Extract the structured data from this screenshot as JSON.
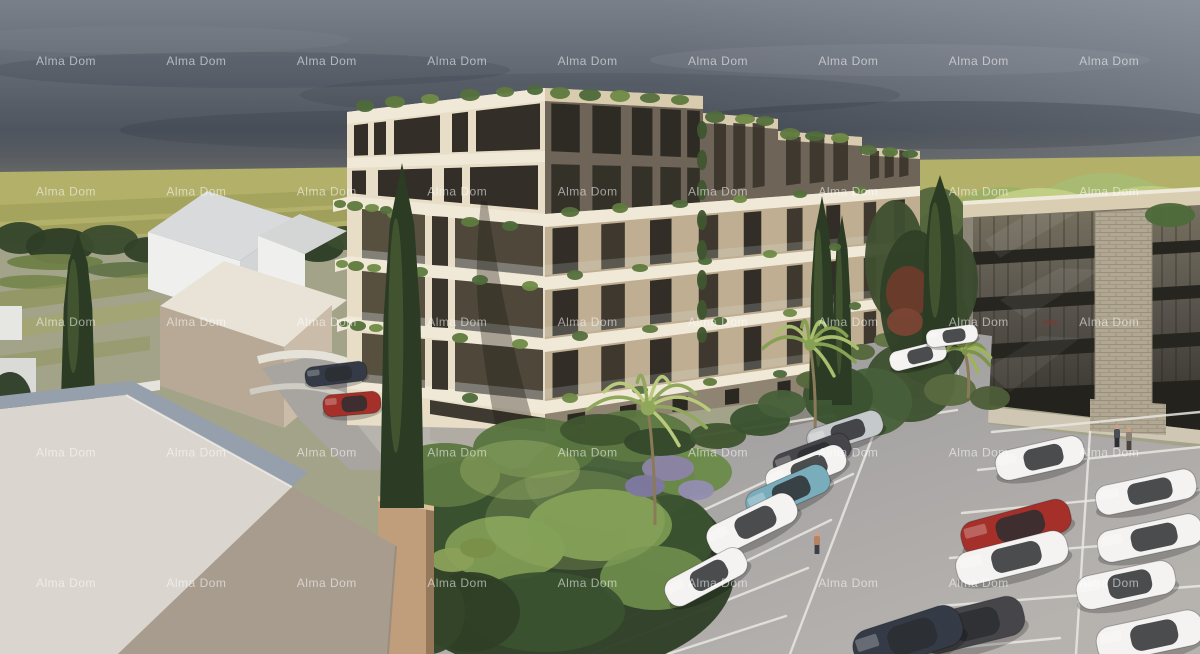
{
  "meta": {
    "type": "architectural-rendering",
    "title": "Alma Dom residential complex 3D visualization",
    "width": 1200,
    "height": 654
  },
  "watermark": {
    "text": "Alma Dom",
    "color": "rgba(255,255,255,0.55)",
    "font_size": 12,
    "grid": {
      "cols": 9,
      "rows": 5,
      "x_start": 66,
      "x_step": 130.4,
      "y_start": 65,
      "y_step": 130.5
    }
  },
  "palette": {
    "sky_top": "#79808a",
    "sky_mid": "#5d636d",
    "sky_low": "#474d57",
    "horizon": "#8f8d80",
    "field": "#b2b069",
    "field_dark": "#9b9c57",
    "ground": "#a2a389",
    "facade_light": "#e8dec8",
    "band_white": "#f1e9d7",
    "facade_tan": "#bfae92",
    "penthouse_dark": "#6e6457",
    "window_dark": "#332f28",
    "recess": "#4e473a",
    "recess2": "#57503f",
    "office_fascia": "#d9cdb2",
    "office_spandrel": "#26251f",
    "stone": "#b1a792",
    "asphalt": "#9c999c",
    "asphalt_light": "#b6b3af",
    "line": "#eae8e3",
    "concrete": "#b7b4ae",
    "roof_light": "#dad5ce",
    "roof_dark": "#a89c8e",
    "roof_blue": "#96a0ac",
    "massing_white": "#eff0ee",
    "massing_roof": "#d8dadb",
    "massing_tan": "#cabca8",
    "tanbox": "#c09e7c"
  },
  "scene": {
    "sky": "overcast evening sky",
    "background": "yellow-green field with dark tree line",
    "main_building": "6-storey apartment building, white balcony bands, rooftop greenery",
    "office_building": "4-storey dark glass building with stone pillar",
    "left_buildings": "untextured white massing houses",
    "foreground": "hip roof of neighbouring house",
    "garden": "courtyard garden with palms and cypresses",
    "parking": "asphalt parking lot with marked bays"
  },
  "parking": {
    "car_colors": {
      "white": "#f4f3f1",
      "silver": "#c6c9cb",
      "red": "#a5302a",
      "teal": "#79adbb",
      "dark": "#46464a",
      "navy": "#343a46"
    },
    "cars": [
      [
        845,
        432,
        78,
        26,
        -18,
        "silver"
      ],
      [
        812,
        456,
        80,
        26,
        -20,
        "dark"
      ],
      [
        806,
        470,
        84,
        28,
        -22,
        "white"
      ],
      [
        788,
        492,
        88,
        30,
        -24,
        "teal"
      ],
      [
        752,
        524,
        96,
        32,
        -26,
        "white"
      ],
      [
        706,
        577,
        88,
        30,
        -28,
        "white"
      ],
      [
        1040,
        458,
        90,
        30,
        -13,
        "white"
      ],
      [
        1016,
        527,
        112,
        34,
        -15,
        "red"
      ],
      [
        1012,
        558,
        114,
        34,
        -14,
        "white"
      ],
      [
        1146,
        492,
        102,
        30,
        -12,
        "white"
      ],
      [
        1150,
        538,
        106,
        32,
        -12,
        "white"
      ],
      [
        1126,
        585,
        100,
        34,
        -12,
        "white"
      ],
      [
        1150,
        636,
        108,
        36,
        -12,
        "white"
      ],
      [
        972,
        625,
        106,
        40,
        -14,
        "dark"
      ],
      [
        908,
        638,
        112,
        42,
        -18,
        "navy"
      ],
      [
        336,
        374,
        62,
        20,
        -7,
        "navy"
      ],
      [
        352,
        404,
        58,
        22,
        -5,
        "red"
      ],
      [
        918,
        356,
        58,
        20,
        -14,
        "white"
      ],
      [
        952,
        336,
        52,
        18,
        -8,
        "white"
      ]
    ],
    "lines": [
      [
        885,
        404,
        790,
        654
      ],
      [
        872,
        432,
        652,
        534
      ],
      [
        853,
        474,
        633,
        578
      ],
      [
        831,
        520,
        612,
        626
      ],
      [
        808,
        568,
        592,
        654
      ],
      [
        786,
        616,
        668,
        654
      ],
      [
        660,
        442,
        880,
        408
      ],
      [
        893,
        420,
        957,
        410
      ],
      [
        1090,
        432,
        1076,
        654
      ],
      [
        978,
        470,
        1200,
        447
      ],
      [
        962,
        513,
        1200,
        490
      ],
      [
        950,
        558,
        1200,
        538
      ],
      [
        940,
        606,
        1200,
        586
      ],
      [
        934,
        650,
        1060,
        638
      ],
      [
        992,
        432,
        1200,
        412
      ]
    ]
  },
  "people": [
    [
      817,
      548,
      "#b5835f",
      "#3d3f46"
    ],
    [
      1117,
      441,
      "#4a4e55",
      "#2c2e33"
    ],
    [
      1129,
      444,
      "#8a8276",
      "#4a443c"
    ]
  ],
  "vegetation": {
    "backL": [
      [
        20,
        238,
        26,
        16,
        "#35462c"
      ],
      [
        60,
        246,
        34,
        18,
        "#2e3d27"
      ],
      [
        108,
        240,
        30,
        15,
        "#3b4c2f"
      ],
      [
        150,
        250,
        26,
        13,
        "#32422a"
      ],
      [
        195,
        247,
        22,
        12,
        "#3b4c2f"
      ],
      [
        232,
        252,
        20,
        11,
        "#32422a"
      ],
      [
        318,
        247,
        26,
        15,
        "#2e3d27"
      ],
      [
        345,
        238,
        20,
        12,
        "#3b4c2f"
      ],
      [
        55,
        262,
        48,
        8,
        "#6f7f48"
      ],
      [
        130,
        270,
        44,
        8,
        "#64744a"
      ],
      [
        35,
        282,
        40,
        7,
        "#77864e"
      ],
      [
        260,
        258,
        30,
        9,
        "#5d6d42"
      ]
    ],
    "backR": [
      [
        1005,
        245,
        75,
        58,
        "#9db065"
      ],
      [
        1105,
        235,
        85,
        62,
        "#a9bb72"
      ],
      [
        1180,
        255,
        65,
        52,
        "#93a75e"
      ],
      [
        975,
        295,
        55,
        35,
        "#5a6a40"
      ],
      [
        1120,
        300,
        70,
        38,
        "#4e5e38"
      ],
      [
        1185,
        300,
        50,
        30,
        "#5a6a40"
      ],
      [
        940,
        265,
        38,
        55,
        "#3c4c2e"
      ],
      [
        1040,
        212,
        55,
        24,
        "#c2cf86"
      ],
      [
        1150,
        208,
        50,
        22,
        "#bccb80"
      ],
      [
        935,
        215,
        30,
        28,
        "#55683c"
      ]
    ],
    "mid": [
      [
        930,
        330,
        40,
        55,
        "#31412a"
      ],
      [
        952,
        282,
        26,
        48,
        "#3a4b2e"
      ],
      [
        910,
        382,
        45,
        40,
        "#3d5130"
      ],
      [
        872,
        402,
        40,
        34,
        "#47603a"
      ],
      [
        838,
        396,
        35,
        30,
        "#3a5230"
      ],
      [
        950,
        390,
        26,
        16,
        "#5a6a40"
      ],
      [
        990,
        398,
        20,
        12,
        "#4e5e38"
      ],
      [
        838,
        366,
        14,
        8,
        "#617444"
      ],
      [
        862,
        352,
        13,
        8,
        "#55683c"
      ],
      [
        886,
        340,
        12,
        7,
        "#617444"
      ],
      [
        812,
        380,
        16,
        9,
        "#55683c"
      ],
      [
        1170,
        215,
        25,
        12,
        "#4e6a3a"
      ],
      [
        895,
        260,
        30,
        60,
        "#3e4f30"
      ],
      [
        915,
        300,
        35,
        70,
        "#314128"
      ],
      [
        908,
        292,
        22,
        26,
        "#6a3b2c"
      ],
      [
        905,
        322,
        18,
        14,
        "#7a4534"
      ]
    ],
    "garden": [
      [
        560,
        570,
        175,
        105,
        "#2f4026"
      ],
      [
        470,
        515,
        75,
        55,
        "#3a5230"
      ],
      [
        610,
        480,
        85,
        50,
        "#47603a"
      ],
      [
        670,
        535,
        45,
        40,
        "#3a5230"
      ],
      [
        445,
        475,
        55,
        32,
        "#5d7842"
      ],
      [
        535,
        448,
        62,
        30,
        "#587540"
      ],
      [
        636,
        436,
        56,
        26,
        "#5d7842"
      ],
      [
        688,
        472,
        44,
        24,
        "#6b8a4a"
      ],
      [
        505,
        548,
        60,
        32,
        "#7f9b53"
      ],
      [
        600,
        525,
        72,
        36,
        "#7a9850"
      ],
      [
        655,
        578,
        55,
        32,
        "#6b8a4a"
      ],
      [
        545,
        612,
        80,
        40,
        "#3a5230"
      ],
      [
        470,
        612,
        50,
        40,
        "#2f4026"
      ],
      [
        575,
        520,
        90,
        50,
        "#a3bc6e",
        0.25
      ],
      [
        520,
        470,
        60,
        30,
        "#b7c976",
        0.3
      ],
      [
        452,
        560,
        22,
        12,
        "#8aa058"
      ],
      [
        478,
        548,
        18,
        10,
        "#7a9048"
      ],
      [
        668,
        468,
        26,
        13,
        "#8b84a6"
      ],
      [
        645,
        486,
        20,
        11,
        "#7f78a0"
      ],
      [
        696,
        490,
        18,
        10,
        "#938cb0"
      ],
      [
        600,
        430,
        40,
        16,
        "#3f5530"
      ],
      [
        660,
        442,
        36,
        14,
        "#35482c"
      ],
      [
        718,
        436,
        28,
        13,
        "#3f5530"
      ],
      [
        10,
        402,
        22,
        30,
        "#2e3d27"
      ],
      [
        430,
        612,
        35,
        42,
        "#33452a"
      ],
      [
        760,
        420,
        30,
        16,
        "#3a5230"
      ],
      [
        782,
        404,
        24,
        14,
        "#47603a"
      ]
    ],
    "clumps": [
      [
        365,
        106,
        9,
        6,
        "#4e6a3a"
      ],
      [
        395,
        102,
        10,
        6,
        "#5f7a3e"
      ],
      [
        430,
        99,
        9,
        5,
        "#6f8a46"
      ],
      [
        470,
        95,
        10,
        6,
        "#55703c"
      ],
      [
        505,
        92,
        9,
        5,
        "#5f7a3e"
      ],
      [
        535,
        90,
        8,
        5,
        "#4e6a3a"
      ],
      [
        560,
        93,
        10,
        6,
        "#5f7a3e"
      ],
      [
        590,
        95,
        11,
        6,
        "#4e6a3a"
      ],
      [
        620,
        96,
        10,
        6,
        "#6f8a46"
      ],
      [
        650,
        98,
        10,
        5,
        "#55703c"
      ],
      [
        680,
        100,
        9,
        5,
        "#5f7a3e"
      ],
      [
        715,
        117,
        10,
        6,
        "#4e6a3a"
      ],
      [
        745,
        119,
        10,
        5,
        "#6f8a46"
      ],
      [
        765,
        121,
        9,
        5,
        "#55703c"
      ],
      [
        790,
        134,
        10,
        6,
        "#5f7a3e"
      ],
      [
        815,
        136,
        10,
        5,
        "#4e6a3a"
      ],
      [
        840,
        138,
        9,
        5,
        "#6f8a46"
      ],
      [
        868,
        150,
        9,
        5,
        "#55703c"
      ],
      [
        890,
        152,
        8,
        5,
        "#5f7a3e"
      ],
      [
        910,
        154,
        8,
        4,
        "#4e6a3a"
      ],
      [
        470,
        222,
        9,
        5,
        "#5f7a3e"
      ],
      [
        510,
        226,
        8,
        5,
        "#4e6a3a"
      ],
      [
        395,
        214,
        8,
        5,
        "#6f8a46"
      ],
      [
        570,
        212,
        9,
        5,
        "#55703c"
      ],
      [
        620,
        208,
        8,
        5,
        "#5f7a3e"
      ],
      [
        680,
        204,
        8,
        4,
        "#4e6a3a"
      ],
      [
        740,
        199,
        7,
        4,
        "#6f8a46"
      ],
      [
        800,
        194,
        7,
        4,
        "#55703c"
      ],
      [
        860,
        190,
        6,
        4,
        "#5f7a3e"
      ],
      [
        420,
        272,
        8,
        5,
        "#5f7a3e"
      ],
      [
        480,
        280,
        8,
        5,
        "#4e6a3a"
      ],
      [
        530,
        286,
        8,
        5,
        "#6f8a46"
      ],
      [
        575,
        275,
        8,
        5,
        "#55703c"
      ],
      [
        640,
        268,
        8,
        4,
        "#5f7a3e"
      ],
      [
        705,
        261,
        7,
        4,
        "#4e6a3a"
      ],
      [
        770,
        254,
        7,
        4,
        "#6f8a46"
      ],
      [
        835,
        247,
        6,
        4,
        "#55703c"
      ],
      [
        400,
        330,
        8,
        5,
        "#4e6a3a"
      ],
      [
        460,
        338,
        8,
        5,
        "#5f7a3e"
      ],
      [
        520,
        344,
        8,
        5,
        "#6f8a46"
      ],
      [
        580,
        336,
        8,
        5,
        "#55703c"
      ],
      [
        650,
        329,
        8,
        4,
        "#5f7a3e"
      ],
      [
        720,
        321,
        7,
        4,
        "#4e6a3a"
      ],
      [
        790,
        313,
        7,
        4,
        "#6f8a46"
      ],
      [
        855,
        306,
        6,
        4,
        "#55703c"
      ],
      [
        410,
        390,
        8,
        5,
        "#5f7a3e"
      ],
      [
        470,
        398,
        8,
        5,
        "#4e6a3a"
      ],
      [
        570,
        398,
        8,
        5,
        "#6f8a46"
      ],
      [
        640,
        390,
        8,
        4,
        "#55703c"
      ],
      [
        710,
        382,
        7,
        4,
        "#5f7a3e"
      ],
      [
        780,
        374,
        7,
        4,
        "#4e6a3a"
      ],
      [
        702,
        130,
        5,
        9,
        "#3f5530"
      ],
      [
        702,
        160,
        5,
        10,
        "#3f5530"
      ],
      [
        702,
        190,
        5,
        10,
        "#3f5530"
      ],
      [
        702,
        220,
        5,
        10,
        "#3f5530"
      ],
      [
        702,
        250,
        5,
        10,
        "#3f5530"
      ],
      [
        702,
        280,
        5,
        10,
        "#3f5530"
      ],
      [
        702,
        310,
        5,
        10,
        "#3f5530"
      ],
      [
        702,
        335,
        5,
        8,
        "#3f5530"
      ],
      [
        355,
        206,
        8,
        5,
        "#5f7a3e"
      ],
      [
        372,
        208,
        7,
        4,
        "#6f8a46"
      ],
      [
        386,
        210,
        6,
        4,
        "#55703c"
      ],
      [
        356,
        266,
        8,
        5,
        "#5f7a3e"
      ],
      [
        374,
        268,
        7,
        4,
        "#6f8a46"
      ],
      [
        358,
        326,
        8,
        5,
        "#55703c"
      ],
      [
        376,
        328,
        7,
        4,
        "#6f8a46"
      ],
      [
        340,
        204,
        6,
        4,
        "#5f7a3e"
      ],
      [
        342,
        264,
        6,
        4,
        "#6f8a46"
      ],
      [
        344,
        324,
        5,
        3,
        "#55703c"
      ]
    ],
    "palms": [
      [
        648,
        408,
        62,
        655,
        525,
        "#b9cb7a",
        "#8fa85c"
      ],
      [
        810,
        345,
        48,
        815,
        430,
        "#aabf6e",
        "#86a054"
      ],
      [
        965,
        352,
        26,
        968,
        398,
        "#9db35c",
        "#7e9448"
      ]
    ],
    "cypresses": [
      [
        402,
        163,
        508,
        44,
        "front"
      ],
      [
        78,
        232,
        400,
        34,
        "front"
      ],
      [
        940,
        175,
        345,
        36,
        "mid"
      ],
      [
        822,
        196,
        400,
        26,
        "mid"
      ],
      [
        842,
        215,
        405,
        20,
        "mid"
      ]
    ]
  }
}
